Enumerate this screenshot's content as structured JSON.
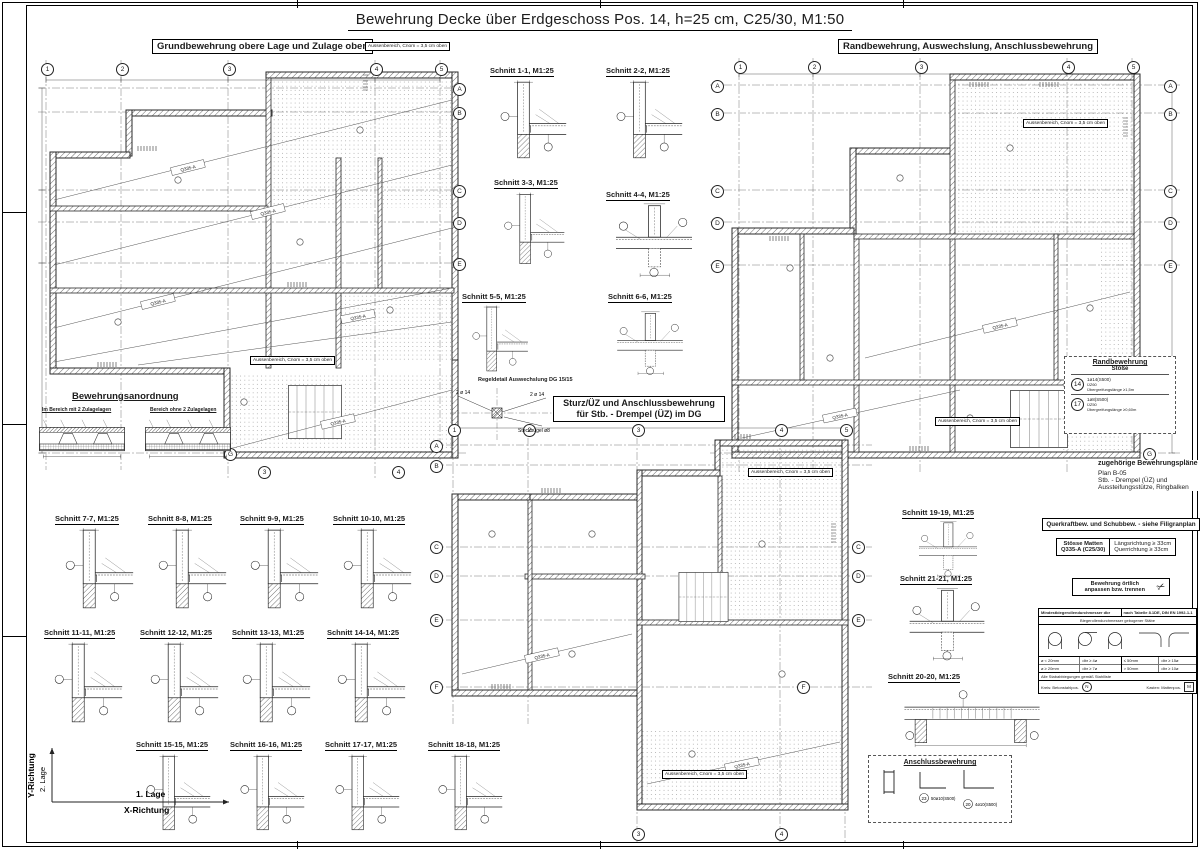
{
  "colors": {
    "ink": "#1c1c1c",
    "hatch": "#6b6b6b",
    "dots": "#8f8f8f",
    "paper": "#ffffff"
  },
  "title": "Bewehrung Decke über Erdgeschoss Pos. 14, h=25 cm, C25/30, M1:50",
  "plan_labels": {
    "left": "Grundbewehrung obere Lage und Zulage oben",
    "right": "Randbewehrung, Auswechslung, Anschlussbewehrung",
    "center1": "Sturz/ÜZ und Anschlussbewehrung",
    "center2": "für Stb. - Drempel (ÜZ) im DG"
  },
  "cover_note": "Aussenbereich, Cnom = 3,5 cm oben",
  "regeldetail": "Regeldetail Auswechslung DG 15/15",
  "steckbuegel": {
    "bars": "2 ø 14",
    "stirrup": "Steckbügel ø8"
  },
  "mesh_label": "Q335-A",
  "grid": {
    "cols": [
      "1",
      "2",
      "3",
      "4",
      "5"
    ],
    "rows": [
      "A",
      "B",
      "C",
      "D",
      "E",
      "F",
      "G"
    ]
  },
  "sections": [
    "Schnitt 1-1, M1:25",
    "Schnitt 2-2, M1:25",
    "Schnitt 3-3, M1:25",
    "Schnitt 4-4, M1:25",
    "Schnitt 5-5, M1:25",
    "Schnitt 6-6, M1:25",
    "Schnitt 7-7, M1:25",
    "Schnitt 8-8, M1:25",
    "Schnitt 9-9, M1:25",
    "Schnitt 10-10, M1:25",
    "Schnitt 11-11, M1:25",
    "Schnitt 12-12, M1:25",
    "Schnitt 13-13, M1:25",
    "Schnitt 14-14, M1:25",
    "Schnitt 15-15, M1:25",
    "Schnitt 16-16, M1:25",
    "Schnitt 17-17, M1:25",
    "Schnitt 18-18, M1:25",
    "Schnitt 19-19, M1:25",
    "Schnitt 20-20, M1:25",
    "Schnitt 21-21, M1:25"
  ],
  "anordnung": {
    "title": "Bewehrungsanordnung",
    "left": "Im Bereich mit 2 Zulagelagen",
    "right": "Bereich ohne 2 Zulagelagen"
  },
  "axis": {
    "y": "Y-Richtung",
    "y2": "2. Lage",
    "x": "1. Lage",
    "x2": "X-Richtung"
  },
  "rand_box": {
    "title": "Randbewehrung",
    "sub": "Stöße",
    "item1_no": "14",
    "item1_l1": "1ø14(S500)",
    "item1_l2": "ÜZ60",
    "item1_l3": "Übergreifungslänge ≥1,5m",
    "item2_no": "17",
    "item2_l1": "1ø8(S500)",
    "item2_l2": "ÜZ50",
    "item2_l3": "Übergreifungslänge ≥0,60m"
  },
  "refs": {
    "title": "zugehörige Bewehrungspläne",
    "l1": "Plan B-05",
    "l2": "Stb. - Drempel (ÜZ) und",
    "l3": "Aussteifungsstütze, Ringbalken"
  },
  "querkraft": "Querkraftbew. und Schubbew. - siehe Filigranplan",
  "stoesse": {
    "l1": "Stösse Matten",
    "l2": "Q335-A (C25/30)",
    "r1": "Längsrichtung ≥ 33cm",
    "r2": "Querrichtung ≥ 33cm"
  },
  "oertlich": {
    "l1": "Bewehrung örtlich",
    "l2": "anpassen bzw. trennen"
  },
  "biege": {
    "title": "Mindestbiegerollendurchmesser dbr",
    "ref": "nach Tabelle 8.1DE, DIN EN 1992-1-1",
    "cap_left": "Biegerollendurchmesser gebogener Stäbe",
    "r1l": "ø < 20mm",
    "r1r": "dbr ≥ 4ø",
    "r2l": "ø ≥ 20mm",
    "r2r": "dbr ≥ 7ø",
    "s1l": "≤ 50mm",
    "s1r": "dbr ≥ 15ø",
    "s2l": "> 50mm",
    "s2r": "dbr ≥ 10ø",
    "foot": "Alle Stababbiegungen gemäß Stahlliste",
    "leg1": "Kreis: Betonstahlpos.",
    "leg1_sym": "N",
    "leg2": "Kasten: Mattenpos.",
    "leg2_sym": "M"
  },
  "anschluss": {
    "title": "Anschlussbewehrung",
    "n1": "23",
    "l1": "50ø10(S500)",
    "n2": "20",
    "l2": "4ø10(S500)"
  }
}
